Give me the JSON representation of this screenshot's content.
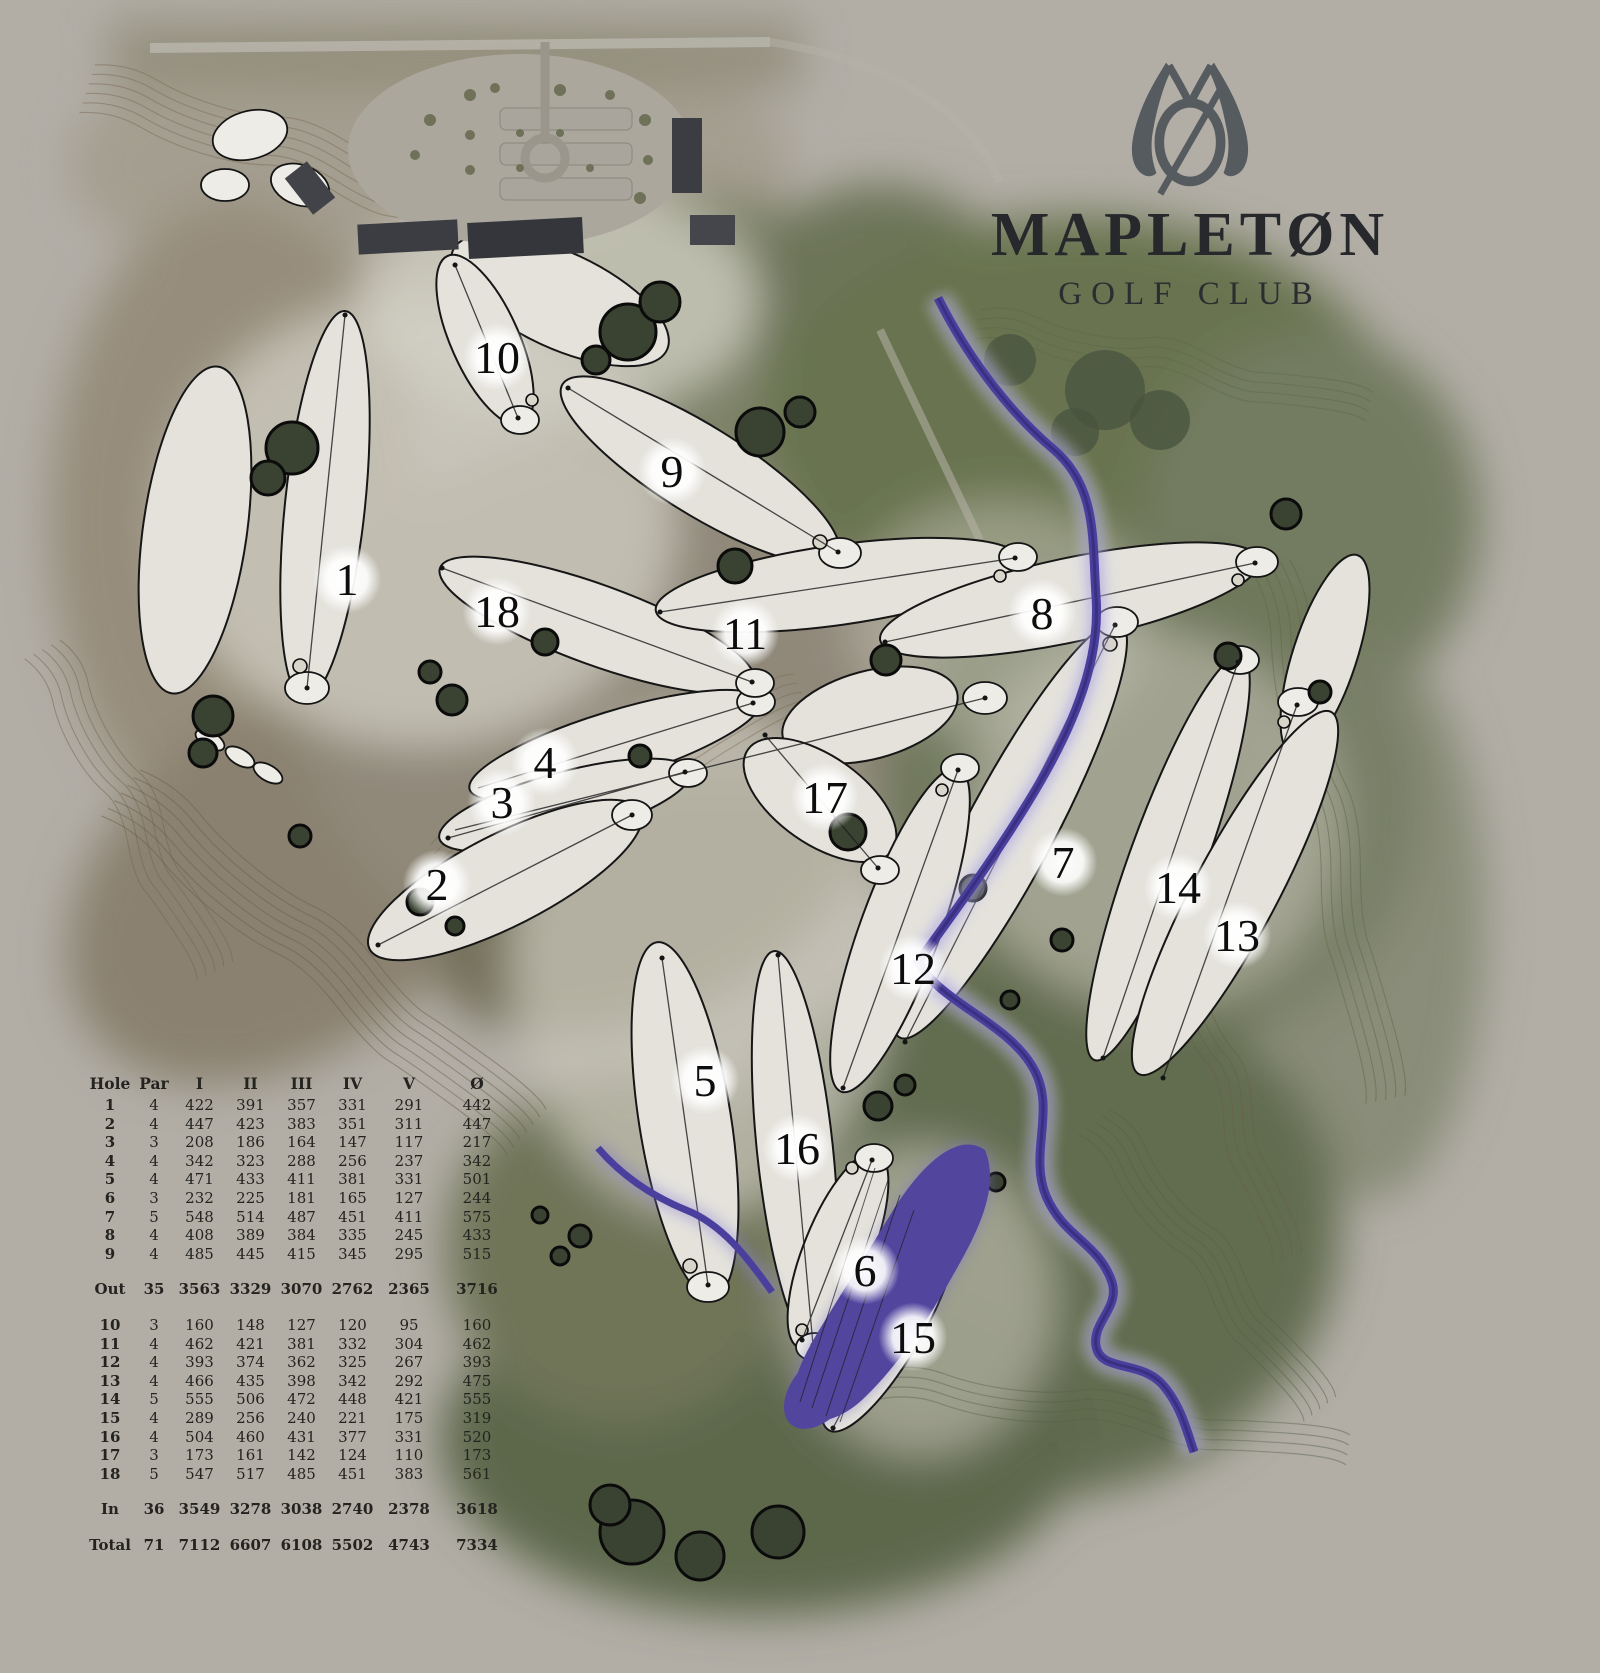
{
  "branding": {
    "club_name": "MAPLETØN",
    "club_type": "GOLF CLUB",
    "logo": "mapleton-monogram-logo"
  },
  "colors": {
    "background": "#b2aea6",
    "river": "#4b3f9e",
    "lake": "#51459e",
    "fairway": "#e4e2db",
    "title_ink": "#26282b",
    "logo": "#565b60"
  },
  "map": {
    "holes": [
      {
        "number": "1",
        "x": 347,
        "y": 579
      },
      {
        "number": "2",
        "x": 437,
        "y": 884
      },
      {
        "number": "3",
        "x": 502,
        "y": 802
      },
      {
        "number": "4",
        "x": 545,
        "y": 762
      },
      {
        "number": "5",
        "x": 705,
        "y": 1080
      },
      {
        "number": "6",
        "x": 865,
        "y": 1270
      },
      {
        "number": "7",
        "x": 1063,
        "y": 862
      },
      {
        "number": "8",
        "x": 1042,
        "y": 613
      },
      {
        "number": "9",
        "x": 672,
        "y": 471
      },
      {
        "number": "10",
        "x": 497,
        "y": 357
      },
      {
        "number": "11",
        "x": 745,
        "y": 633
      },
      {
        "number": "12",
        "x": 913,
        "y": 968
      },
      {
        "number": "13",
        "x": 1237,
        "y": 935
      },
      {
        "number": "14",
        "x": 1178,
        "y": 887
      },
      {
        "number": "15",
        "x": 913,
        "y": 1337
      },
      {
        "number": "16",
        "x": 797,
        "y": 1148
      },
      {
        "number": "17",
        "x": 825,
        "y": 797
      },
      {
        "number": "18",
        "x": 497,
        "y": 611
      }
    ]
  },
  "scorecard": {
    "headers": [
      "Hole",
      "Par",
      "I",
      "II",
      "III",
      "IV",
      "V",
      "Ø"
    ],
    "rows": [
      {
        "style": "hole",
        "cells": [
          "1",
          "4",
          "422",
          "391",
          "357",
          "331",
          "291",
          "442"
        ]
      },
      {
        "style": "hole",
        "cells": [
          "2",
          "4",
          "447",
          "423",
          "383",
          "351",
          "311",
          "447"
        ]
      },
      {
        "style": "hole",
        "cells": [
          "3",
          "3",
          "208",
          "186",
          "164",
          "147",
          "117",
          "217"
        ]
      },
      {
        "style": "hole",
        "cells": [
          "4",
          "4",
          "342",
          "323",
          "288",
          "256",
          "237",
          "342"
        ]
      },
      {
        "style": "hole",
        "cells": [
          "5",
          "4",
          "471",
          "433",
          "411",
          "381",
          "331",
          "501"
        ]
      },
      {
        "style": "hole",
        "cells": [
          "6",
          "3",
          "232",
          "225",
          "181",
          "165",
          "127",
          "244"
        ]
      },
      {
        "style": "hole",
        "cells": [
          "7",
          "5",
          "548",
          "514",
          "487",
          "451",
          "411",
          "575"
        ]
      },
      {
        "style": "hole",
        "cells": [
          "8",
          "4",
          "408",
          "389",
          "384",
          "335",
          "245",
          "433"
        ]
      },
      {
        "style": "hole",
        "cells": [
          "9",
          "4",
          "485",
          "445",
          "415",
          "345",
          "295",
          "515"
        ]
      },
      {
        "style": "summary gap",
        "cells": [
          "Out",
          "35",
          "3563",
          "3329",
          "3070",
          "2762",
          "2365",
          "3716"
        ]
      },
      {
        "style": "hole gap",
        "cells": [
          "10",
          "3",
          "160",
          "148",
          "127",
          "120",
          "95",
          "160"
        ]
      },
      {
        "style": "hole",
        "cells": [
          "11",
          "4",
          "462",
          "421",
          "381",
          "332",
          "304",
          "462"
        ]
      },
      {
        "style": "hole",
        "cells": [
          "12",
          "4",
          "393",
          "374",
          "362",
          "325",
          "267",
          "393"
        ]
      },
      {
        "style": "hole",
        "cells": [
          "13",
          "4",
          "466",
          "435",
          "398",
          "342",
          "292",
          "475"
        ]
      },
      {
        "style": "hole",
        "cells": [
          "14",
          "5",
          "555",
          "506",
          "472",
          "448",
          "421",
          "555"
        ]
      },
      {
        "style": "hole",
        "cells": [
          "15",
          "4",
          "289",
          "256",
          "240",
          "221",
          "175",
          "319"
        ]
      },
      {
        "style": "hole",
        "cells": [
          "16",
          "4",
          "504",
          "460",
          "431",
          "377",
          "331",
          "520"
        ]
      },
      {
        "style": "hole",
        "cells": [
          "17",
          "3",
          "173",
          "161",
          "142",
          "124",
          "110",
          "173"
        ]
      },
      {
        "style": "hole",
        "cells": [
          "18",
          "5",
          "547",
          "517",
          "485",
          "451",
          "383",
          "561"
        ]
      },
      {
        "style": "summary gap",
        "cells": [
          "In",
          "36",
          "3549",
          "3278",
          "3038",
          "2740",
          "2378",
          "3618"
        ]
      },
      {
        "style": "summary gap",
        "cells": [
          "Total",
          "71",
          "7112",
          "6607",
          "6108",
          "5502",
          "4743",
          "7334"
        ]
      }
    ]
  }
}
